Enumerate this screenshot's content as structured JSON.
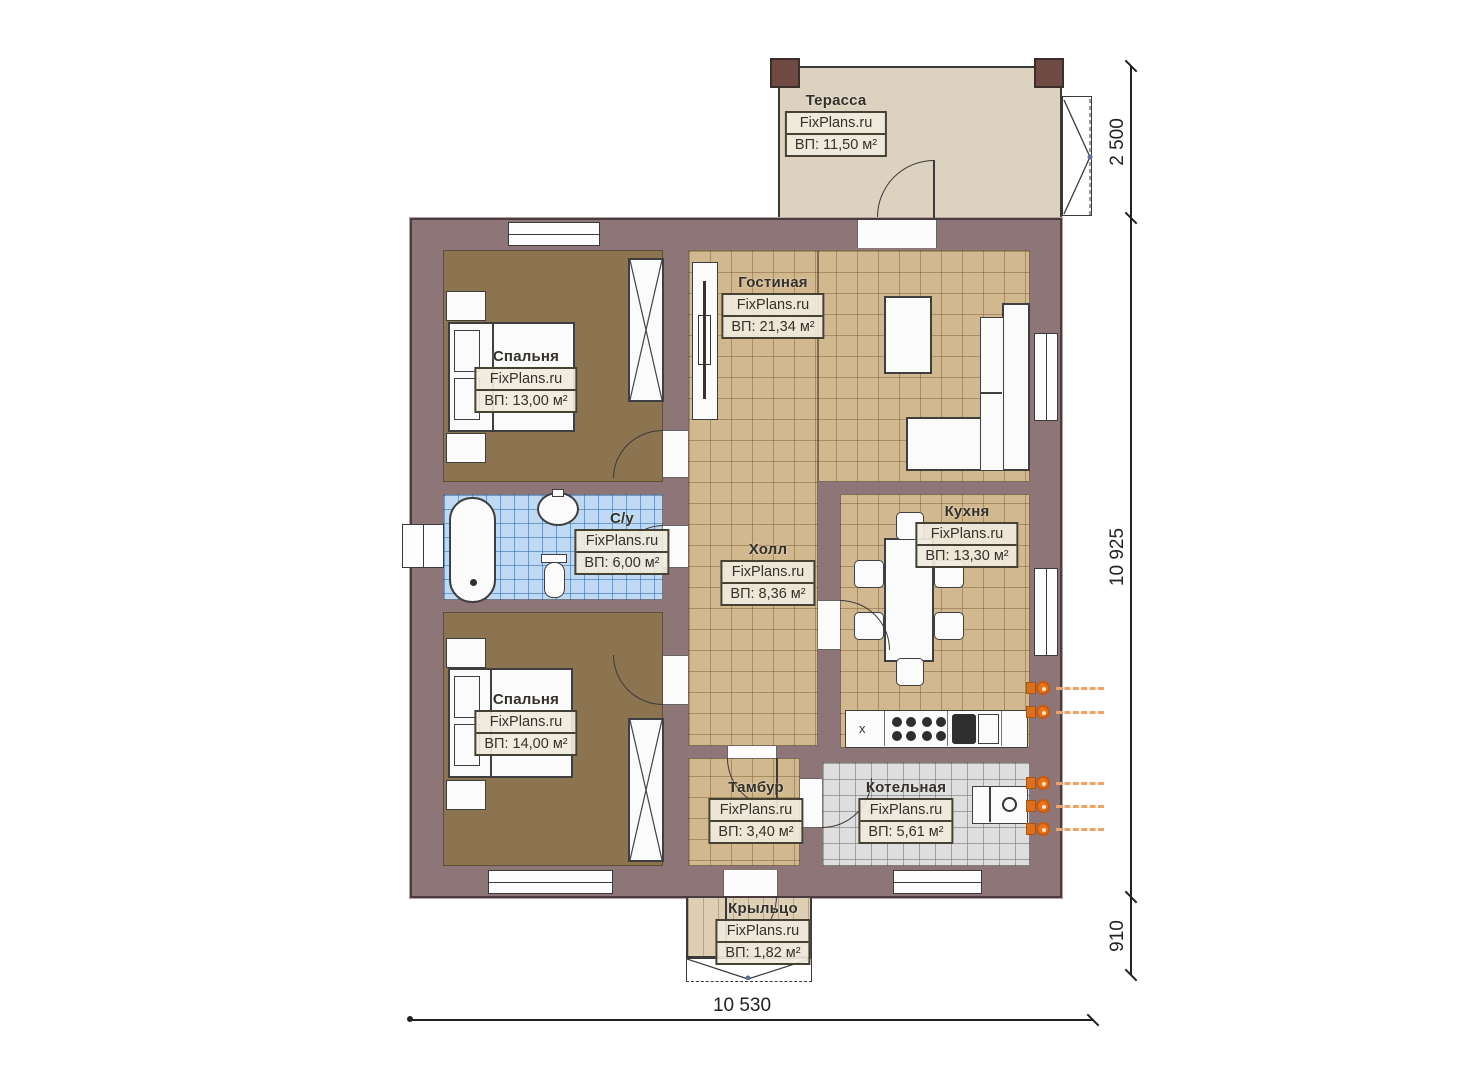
{
  "brand": "FixPlans.ru",
  "rooms": {
    "terrace": {
      "name": "Терасса",
      "area": "ВП: 11,50 м²"
    },
    "living": {
      "name": "Гостиная",
      "area": "ВП: 21,34 м²"
    },
    "bedroom1": {
      "name": "Спальня",
      "area": "ВП: 13,00 м²"
    },
    "bathroom": {
      "name": "С/у",
      "area": "ВП: 6,00 м²"
    },
    "hall": {
      "name": "Холл",
      "area": "ВП: 8,36 м²"
    },
    "kitchen": {
      "name": "Кухня",
      "area": "ВП: 13,30 м²"
    },
    "bedroom2": {
      "name": "Спальня",
      "area": "ВП: 14,00 м²"
    },
    "tambour": {
      "name": "Тамбур",
      "area": "ВП: 3,40 м²"
    },
    "boiler": {
      "name": "Котельная",
      "area": "ВП: 5,61 м²"
    },
    "porch": {
      "name": "Крыльцо",
      "area": "ВП: 1,82 м²"
    }
  },
  "kitchen_marker": "x",
  "dimensions": {
    "right_top": "2 500",
    "right_middle": "10 925",
    "right_bottom": "910",
    "bottom": "10 530"
  },
  "colors": {
    "wall": "#8d7578",
    "floor_tan": "#d2b88e",
    "floor_brown": "#8b744f",
    "floor_blue": "#bed9f1",
    "floor_gray": "#dedede",
    "terrace": "#ddd2c0",
    "porch": "#decfb4",
    "pipe_orange": "#e8731c"
  }
}
